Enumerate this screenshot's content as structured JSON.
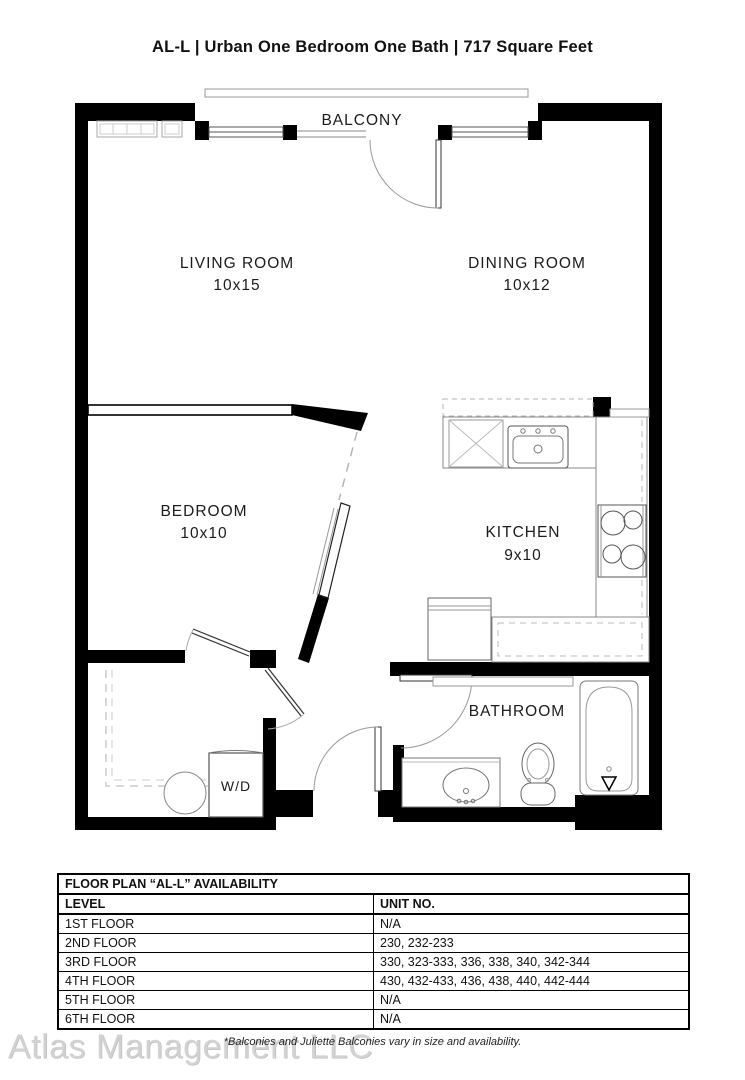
{
  "title": "AL-L | Urban One Bedroom One Bath | 717  Square Feet",
  "floor_plan": {
    "balcony_label": "BALCONY",
    "rooms": {
      "living": {
        "name": "LIVING ROOM",
        "dims": "10x15"
      },
      "dining": {
        "name": "DINING ROOM",
        "dims": "10x12"
      },
      "bedroom": {
        "name": "BEDROOM",
        "dims": "10x10"
      },
      "kitchen": {
        "name": "KITCHEN",
        "dims": "9x10"
      },
      "bathroom": {
        "name": "BATHROOM"
      },
      "laundry": {
        "name": "W/D"
      }
    },
    "colors": {
      "wall": "#000000",
      "fixture_line": "#888888"
    }
  },
  "availability_table": {
    "title": "FLOOR PLAN “AL-L” AVAILABILITY",
    "columns": [
      "LEVEL",
      "UNIT NO."
    ],
    "rows": [
      [
        "1ST FLOOR",
        "N/A"
      ],
      [
        "2ND FLOOR",
        "230, 232-233"
      ],
      [
        "3RD FLOOR",
        "330, 323-333, 336, 338, 340, 342-344"
      ],
      [
        "4TH FLOOR",
        "430, 432-433, 436, 438, 440, 442-444"
      ],
      [
        "5TH FLOOR",
        "N/A"
      ],
      [
        "6TH FLOOR",
        "N/A"
      ]
    ]
  },
  "footnote": "*Balconies and Juliette Balconies vary in size and availability.",
  "watermark": "Atlas Management LLC"
}
